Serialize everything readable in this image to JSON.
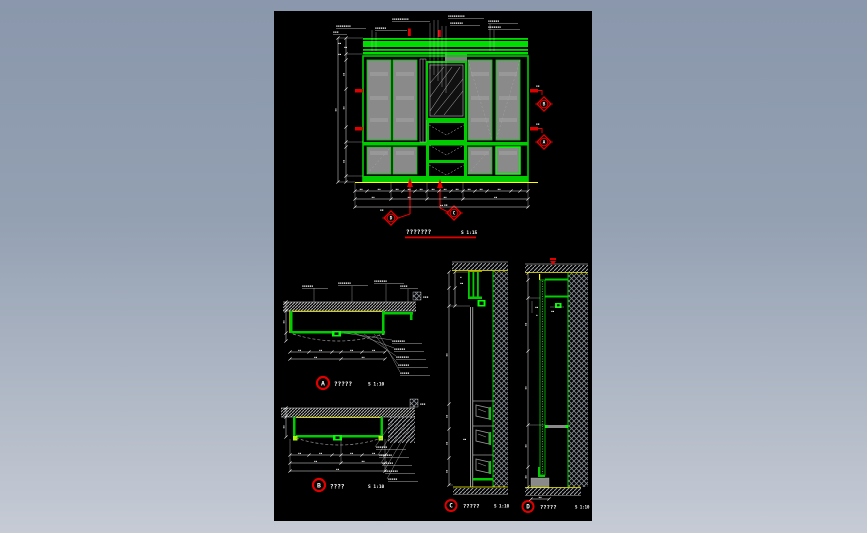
{
  "colors": {
    "line_green": "#00cc00",
    "bright_green": "#00ff00",
    "marker_red": "#e00000",
    "accent_yellow": "#ffff00",
    "panel_gray": "#8a8a8a",
    "hatch_gray": "#a0a4aa",
    "background_top": "#8a97ac",
    "background_bottom": "#c6cbd5",
    "canvas_black": "#000000"
  },
  "elevation": {
    "title": "???????",
    "scale": "S 1:15",
    "top_annotations": [
      "▪▪▪▪▪▪▪▪",
      "▪▪▪▪▪▪",
      "▪▪▪▪▪▪▪▪▪",
      "▪▪▪▪▪▪▪▪▪",
      "▪▪▪▪▪▪▪",
      "▪▪▪▪▪▪",
      "▪▪▪▪▪▪▪",
      "▪▪▪"
    ],
    "cut_marker_b": {
      "letter": "B",
      "tag": "▪▪"
    },
    "cut_marker_a": {
      "letter": "A",
      "tag": "▪▪"
    },
    "cut_marker_d": {
      "letter": "D",
      "tag": "▪▪"
    },
    "cut_marker_c": {
      "letter": "C",
      "tag": "▪▪"
    },
    "dim_marks": [
      "▪▪",
      "▪▪",
      "▪▪",
      "▪▪",
      "▪▪",
      "▪▪",
      "▪▪",
      "▪▪",
      "▪▪",
      "▪▪"
    ]
  },
  "detail_a": {
    "letter": "A",
    "title": "?????",
    "scale": "S 1:10",
    "top_annotations": [
      "▪▪▪▪▪▪",
      "▪▪▪▪▪▪▪",
      "▪▪▪▪▪▪▪",
      "▪▪▪▪"
    ],
    "side_annotations": [
      "▪▪▪▪▪▪▪",
      "▪▪▪▪▪▪",
      "▪▪▪▪▪▪▪",
      "▪▪▪▪▪▪",
      "▪▪▪▪▪"
    ],
    "corner_tag": "▪▪▪"
  },
  "detail_b": {
    "letter": "B",
    "title": "????",
    "scale": "S 1:10",
    "side_annotations": [
      "▪▪▪▪▪▪",
      "▪▪▪▪▪▪▪",
      "▪▪▪▪▪▪",
      "▪▪▪▪▪▪▪",
      "▪▪▪▪▪"
    ],
    "corner_tag": "▪▪▪"
  },
  "section_c": {
    "letter": "C",
    "title": "?????",
    "scale": "S 1:10",
    "marks": [
      "▪",
      "▪▪",
      "▪▪"
    ]
  },
  "section_d": {
    "letter": "D",
    "title": "?????",
    "scale": "S 1:10",
    "marks": [
      "▪▪",
      "▪▪",
      "▪"
    ]
  }
}
